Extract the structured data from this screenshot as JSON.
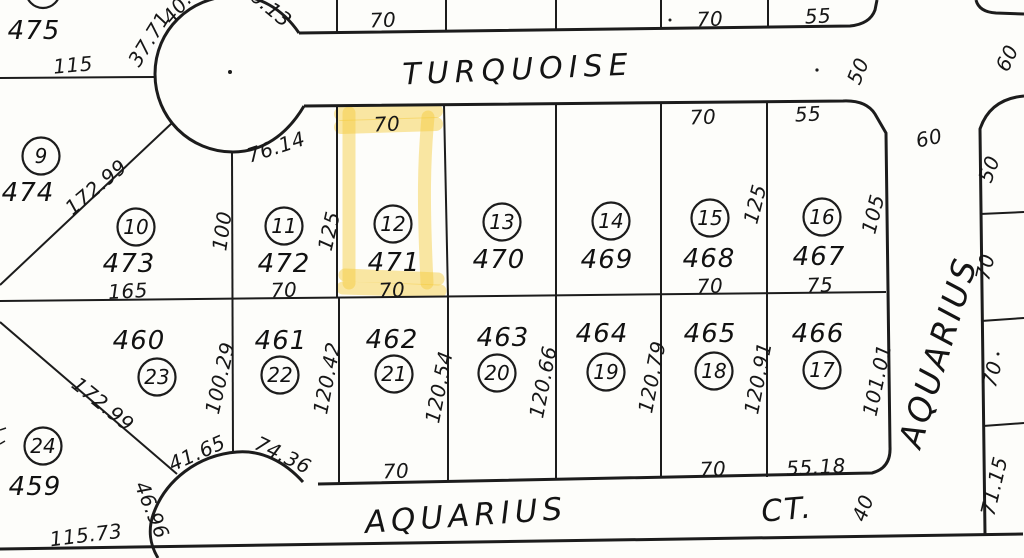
{
  "map": {
    "streets": {
      "turquoise": "TURQUOISE",
      "aquarius_bottom": "AQUARIUS",
      "aquarius_ct_suffix": "CT.",
      "aquarius_right": "AQUARIUS"
    },
    "highlight_color": "#f3c937",
    "highlighted_lot": "12",
    "highlighted_parcel": "471",
    "extra_parcels": [
      {
        "parcel": "475",
        "x": 34,
        "y": 31
      }
    ],
    "lots": [
      {
        "num": "9",
        "cx": 41,
        "cy": 156,
        "parcel": "474",
        "px": 28,
        "py": 193
      },
      {
        "num": "10",
        "cx": 136,
        "cy": 227,
        "parcel": "473",
        "px": 129,
        "py": 264
      },
      {
        "num": "11",
        "cx": 284,
        "cy": 226,
        "parcel": "472",
        "px": 284,
        "py": 264
      },
      {
        "num": "12",
        "cx": 393,
        "cy": 224,
        "parcel": "471",
        "px": 394,
        "py": 263
      },
      {
        "num": "13",
        "cx": 502,
        "cy": 222,
        "parcel": "470",
        "px": 499,
        "py": 260
      },
      {
        "num": "14",
        "cx": 611,
        "cy": 221,
        "parcel": "469",
        "px": 607,
        "py": 260
      },
      {
        "num": "15",
        "cx": 710,
        "cy": 218,
        "parcel": "468",
        "px": 709,
        "py": 259
      },
      {
        "num": "16",
        "cx": 822,
        "cy": 217,
        "parcel": "467",
        "px": 819,
        "py": 257
      },
      {
        "num": "17",
        "cx": 822,
        "cy": 370,
        "parcel": "466",
        "px": 818,
        "py": 334
      },
      {
        "num": "18",
        "cx": 714,
        "cy": 371,
        "parcel": "465",
        "px": 710,
        "py": 334
      },
      {
        "num": "19",
        "cx": 606,
        "cy": 372,
        "parcel": "464",
        "px": 602,
        "py": 334
      },
      {
        "num": "20",
        "cx": 497,
        "cy": 373,
        "parcel": "463",
        "px": 503,
        "py": 338
      },
      {
        "num": "21",
        "cx": 394,
        "cy": 374,
        "parcel": "462",
        "px": 392,
        "py": 340
      },
      {
        "num": "22",
        "cx": 280,
        "cy": 375,
        "parcel": "461",
        "px": 281,
        "py": 341
      },
      {
        "num": "23",
        "cx": 157,
        "cy": 377,
        "parcel": "460",
        "px": 139,
        "py": 341
      },
      {
        "num": "24",
        "cx": 43,
        "cy": 446,
        "parcel": "459",
        "px": 35,
        "py": 487
      }
    ],
    "dimensions": [
      {
        "t": "115",
        "x": 73,
        "y": 65,
        "r": -5
      },
      {
        "t": "37.71",
        "x": 149,
        "y": 39,
        "r": -58
      },
      {
        "t": "40.",
        "x": 177,
        "y": 8,
        "r": -50
      },
      {
        "t": "6.13",
        "x": 271,
        "y": 8,
        "r": 40
      },
      {
        "t": "70",
        "x": 383,
        "y": 20,
        "r": -2
      },
      {
        "t": "70",
        "x": 710,
        "y": 19,
        "r": -2
      },
      {
        "t": "55",
        "x": 818,
        "y": 16,
        "r": -3
      },
      {
        "t": "50",
        "x": 858,
        "y": 71,
        "r": -68
      },
      {
        "t": "60",
        "x": 1007,
        "y": 58,
        "r": -65
      },
      {
        "t": "60",
        "x": 929,
        "y": 138,
        "r": -12
      },
      {
        "t": "76.14",
        "x": 276,
        "y": 147,
        "r": -18
      },
      {
        "t": "70",
        "x": 387,
        "y": 124,
        "r": -3
      },
      {
        "t": "70",
        "x": 703,
        "y": 117,
        "r": -2
      },
      {
        "t": "55",
        "x": 808,
        "y": 114,
        "r": -3
      },
      {
        "t": "125",
        "x": 329,
        "y": 231,
        "r": -77
      },
      {
        "t": "100",
        "x": 222,
        "y": 231,
        "r": -82
      },
      {
        "t": "125",
        "x": 755,
        "y": 204,
        "r": -76
      },
      {
        "t": "105",
        "x": 873,
        "y": 214,
        "r": -76
      },
      {
        "t": "50",
        "x": 989,
        "y": 169,
        "r": -70
      },
      {
        "t": "70",
        "x": 985,
        "y": 267,
        "r": -77
      },
      {
        "t": "172.99",
        "x": 96,
        "y": 187,
        "r": -40
      },
      {
        "t": "165",
        "x": 128,
        "y": 291,
        "r": -3
      },
      {
        "t": "70",
        "x": 284,
        "y": 290,
        "r": -2
      },
      {
        "t": "70",
        "x": 392,
        "y": 290,
        "r": -3
      },
      {
        "t": "70",
        "x": 710,
        "y": 286,
        "r": -2
      },
      {
        "t": "75",
        "x": 820,
        "y": 285,
        "r": -2
      },
      {
        "t": "172.99",
        "x": 103,
        "y": 404,
        "r": 39
      },
      {
        "t": "100.29",
        "x": 220,
        "y": 378,
        "r": -77
      },
      {
        "t": "120.42",
        "x": 327,
        "y": 378,
        "r": -79
      },
      {
        "t": "120.54",
        "x": 439,
        "y": 387,
        "r": -79
      },
      {
        "t": "120.66",
        "x": 543,
        "y": 382,
        "r": -79
      },
      {
        "t": "120.79",
        "x": 652,
        "y": 377,
        "r": -79
      },
      {
        "t": "120.91",
        "x": 758,
        "y": 378,
        "r": -79
      },
      {
        "t": "101.01",
        "x": 877,
        "y": 380,
        "r": -78
      },
      {
        "t": "70",
        "x": 992,
        "y": 374,
        "r": -76
      },
      {
        "t": "41.65",
        "x": 197,
        "y": 453,
        "r": -24
      },
      {
        "t": "74.36",
        "x": 283,
        "y": 455,
        "r": 26
      },
      {
        "t": "46.96",
        "x": 152,
        "y": 510,
        "r": 68
      },
      {
        "t": "115.73",
        "x": 86,
        "y": 535,
        "r": -7
      },
      {
        "t": "70",
        "x": 396,
        "y": 471,
        "r": -2
      },
      {
        "t": "70",
        "x": 713,
        "y": 469,
        "r": -2
      },
      {
        "t": "55.18",
        "x": 816,
        "y": 467,
        "r": -3
      },
      {
        "t": "71.15",
        "x": 994,
        "y": 486,
        "r": -77
      },
      {
        "t": "40",
        "x": 863,
        "y": 508,
        "r": -70
      }
    ]
  }
}
